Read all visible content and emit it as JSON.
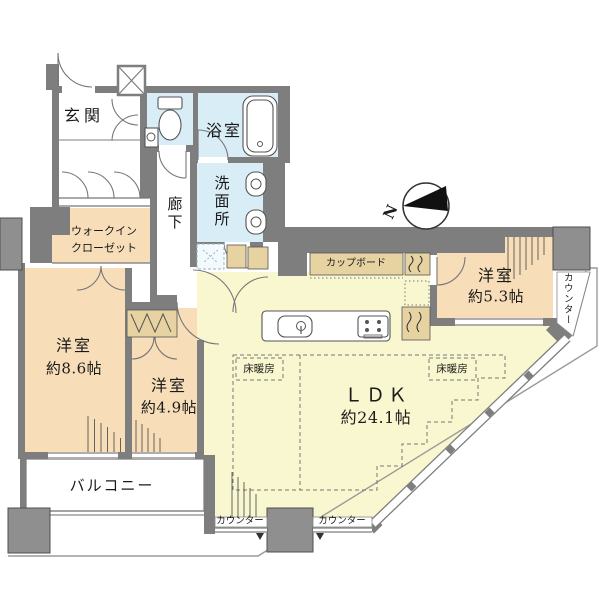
{
  "plan": {
    "compass": {
      "north_label": "N"
    },
    "rooms": {
      "entrance": {
        "label": "玄関"
      },
      "bathroom": {
        "label": "浴室"
      },
      "washroom": {
        "label": "洗面所"
      },
      "corridor": {
        "label": "廊下"
      },
      "walk_in_closet": {
        "label_line1": "ウォークイン",
        "label_line2": "クローゼット"
      },
      "bedroom_8_6": {
        "label": "洋室",
        "area": "約8.6帖"
      },
      "bedroom_4_9": {
        "label": "洋室",
        "area": "約4.9帖"
      },
      "bedroom_5_3": {
        "label": "洋室",
        "area": "約5.3帖"
      },
      "ldk": {
        "label": "ＬＤＫ",
        "area": "約24.1帖"
      },
      "balcony": {
        "label": "バルコニー"
      }
    },
    "features": {
      "cupboard_label": "カップボード",
      "floor_heating_left_label": "床暖房",
      "floor_heating_right_label": "床暖房",
      "counter_bottom_left_label": "カウンター",
      "counter_bottom_right_label": "カウンター",
      "counter_right_label": "カウンター"
    },
    "colors": {
      "wall": "#7e7e7e",
      "pillar": "#8f8f8f",
      "bedroom_fill": "#f7ddb8",
      "wet_area_fill": "#d9edf6",
      "ldk_fill": "#f9f7cf",
      "cabinet_fill": "#e7d2a2",
      "outline": "#999999",
      "text": "#1a1a1a",
      "background": "#ffffff"
    }
  }
}
